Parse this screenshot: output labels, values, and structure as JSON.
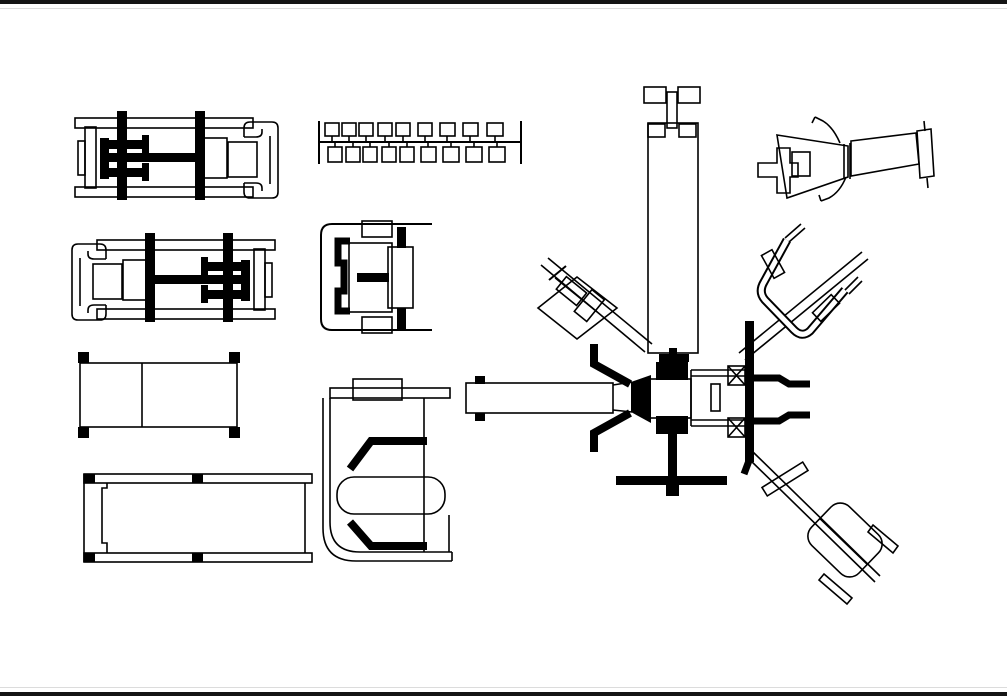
{
  "page": {
    "background": "#ffffff",
    "edge_bar_color": "#141414",
    "edge_line_color": "#dcdcdc",
    "line_color": "#000000"
  },
  "drawing": {
    "type": "cad-block-library",
    "description": "Gym and fitness equipment CAD blocks drawn in plan (top) view, black line art on white",
    "blocks": [
      {
        "name": "press-bench-machine-plan-right",
        "bbox": [
          75,
          108,
          205,
          92
        ]
      },
      {
        "name": "press-bench-machine-plan-left",
        "bbox": [
          72,
          230,
          205,
          92
        ]
      },
      {
        "name": "flat-bench-plan",
        "bbox": [
          78,
          352,
          162,
          86
        ]
      },
      {
        "name": "long-bench-plan",
        "bbox": [
          84,
          474,
          228,
          88
        ]
      },
      {
        "name": "dumbbell-rack-plan",
        "bbox": [
          318,
          118,
          204,
          48
        ]
      },
      {
        "name": "seated-exercise-machine-plan",
        "bbox": [
          320,
          221,
          112,
          110
        ]
      },
      {
        "name": "chest-press-machine-plan",
        "bbox": [
          322,
          378,
          131,
          184
        ]
      },
      {
        "name": "multi-station-gym-plan",
        "bbox": [
          466,
          86,
          469,
          518
        ]
      },
      {
        "name": "inclined-bench-machine-plan",
        "bbox": [
          758,
          112,
          177,
          93
        ]
      }
    ]
  }
}
